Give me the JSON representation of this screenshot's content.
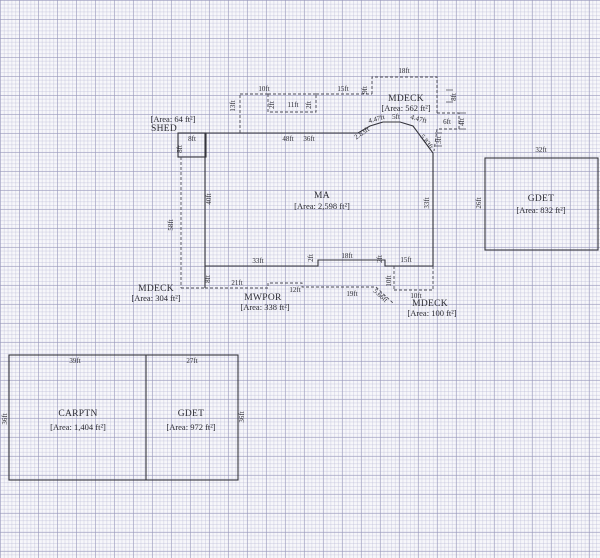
{
  "structures": {
    "ma": {
      "label": "MA",
      "area": "[Area: 2,598 ft²]"
    },
    "shed": {
      "label": "SHED",
      "area": "[Area: 64 ft²]"
    },
    "deck_top": {
      "label": "MDECK",
      "area": "[Area: 562 ft²]"
    },
    "deck_left": {
      "label": "MDECK",
      "area": "[Area: 304 ft²]"
    },
    "deck_br": {
      "label": "MDECK",
      "area": "[Area: 100 ft²]"
    },
    "porch": {
      "label": "MWPOR",
      "area": "[Area: 338 ft²]"
    },
    "garage_right": {
      "label": "GDET",
      "area": "[Area: 832 ft²]"
    },
    "carport": {
      "label": "CARPTN",
      "area": "[Area: 1,404 ft²]"
    },
    "garage_bottom": {
      "label": "GDET",
      "area": "[Area: 972 ft²]"
    }
  },
  "dims": {
    "top_deck_w": "18ft",
    "top_deck_left_h": "9ft",
    "top_deck_right_h": "8ft",
    "nook_w": "6ft",
    "nook_h": "4ft",
    "nook_below": "3ft",
    "top_seg_15": "15ft",
    "top_seg_10": "10ft",
    "top_seg_11": "11ft",
    "notch_left": "2ft",
    "notch_right": "2ft",
    "step_vert": "13ft",
    "shed_w": "8ft",
    "shed_h": "8ft",
    "top_wall_a": "48ft",
    "top_wall_b": "36ft",
    "diag_a": "2.83ft",
    "diag_b": "4.47ft",
    "diag_c": "5ft",
    "diag_d": "4.47ft",
    "diag_e": "5.83ft",
    "ma_left_h": "40ft",
    "ma_right_h": "33ft",
    "left_deck_h": "58ft",
    "bottom_seg_33": "33ft",
    "bottom_seg_18": "18ft",
    "bottom_seg_15": "15ft",
    "bottom_step_l": "2ft",
    "bottom_step_r": "2ft",
    "left_lower_h": "8ft",
    "porch_seg_21": "21ft",
    "porch_seg_12": "12ft",
    "porch_seg_19": "19ft",
    "porch_diag": "5.66ft",
    "br_deck_left_h": "10ft",
    "br_deck_w": "10ft",
    "gdet_r_w": "32ft",
    "gdet_r_h": "26ft",
    "carptn_w": "39ft",
    "carptn_h": "36ft",
    "gdet_b_w": "27ft",
    "gdet_b_h": "36ft"
  },
  "colors": {
    "paper": "#f7f7fa",
    "grid_minor": "#e3e3ef",
    "grid_major": "#c7c7da",
    "wall": "#34343c",
    "dashed_line": "#4a4a55",
    "text": "#2b2b33"
  }
}
